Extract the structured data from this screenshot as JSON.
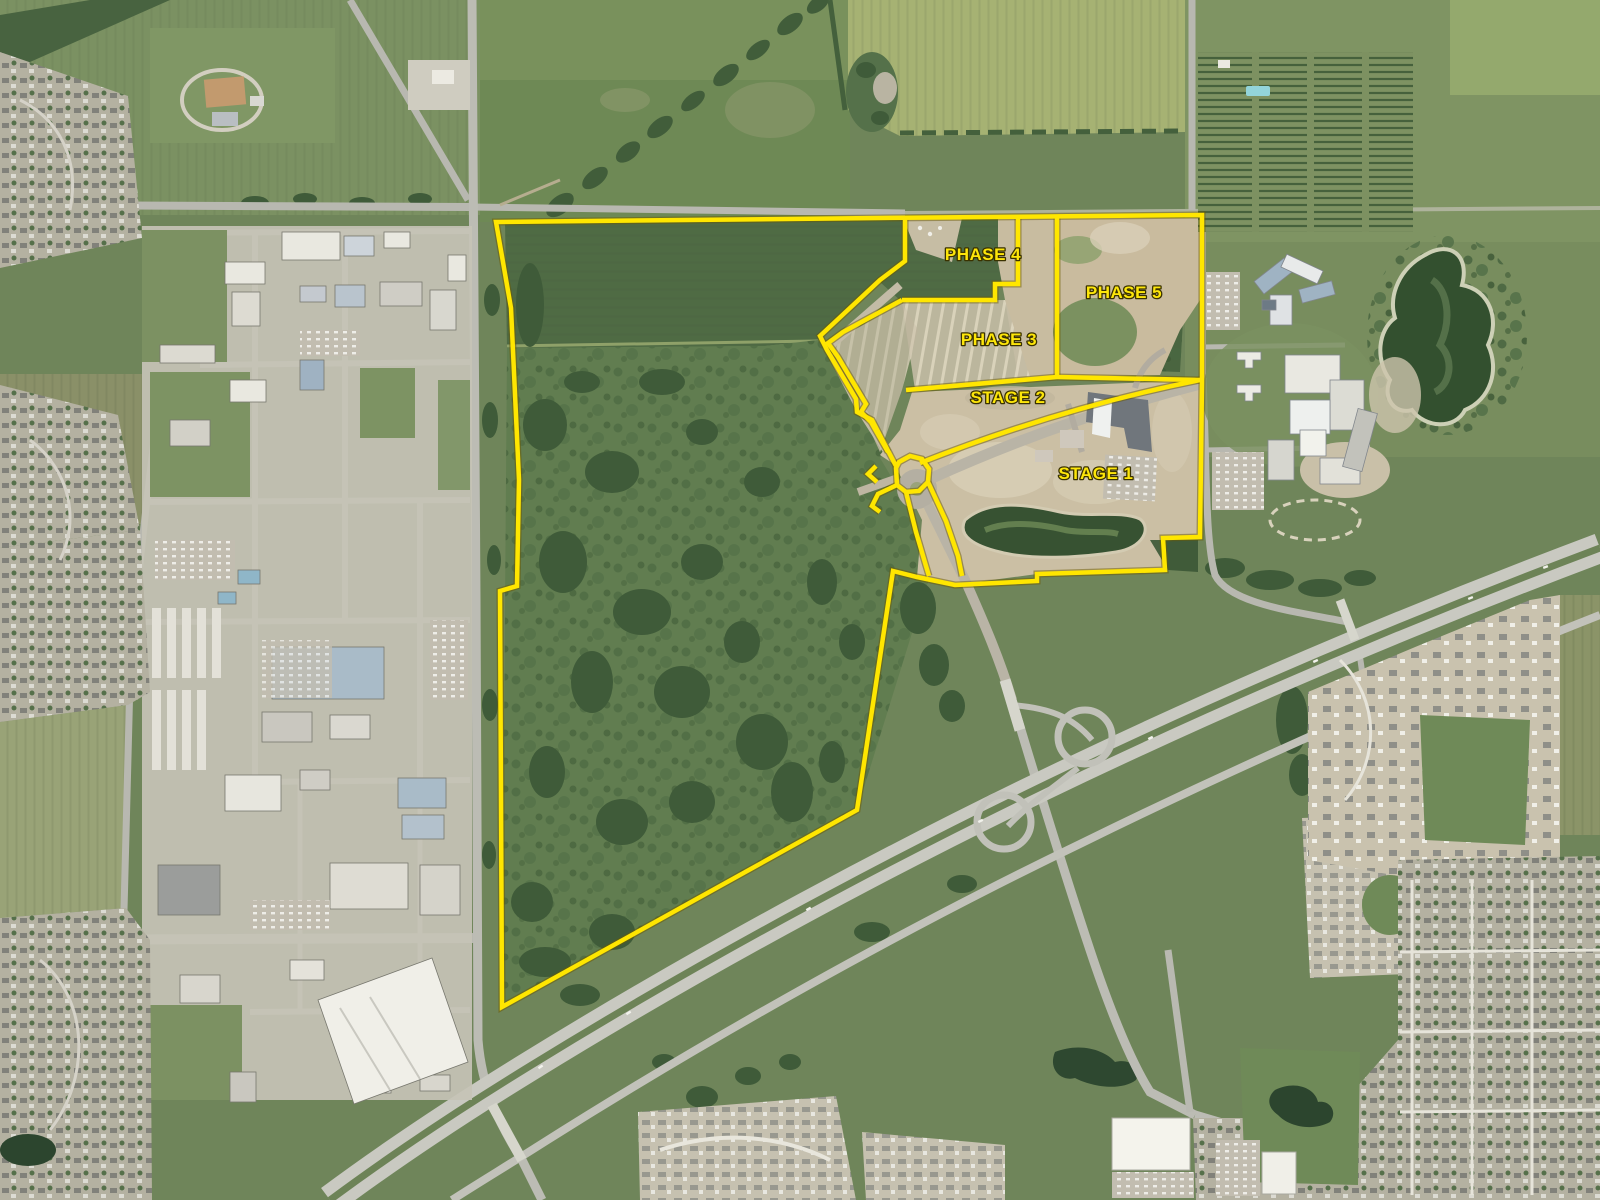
{
  "map": {
    "kind": "aerial-development-phasing-map",
    "overlay": {
      "line_color": "#ffe600",
      "line_outline_color": "#6b5a00",
      "line_width": 4.5,
      "label_color": "#fde60a",
      "label_outline_color": "#3a3200",
      "label_font_size": 17,
      "regions": [
        {
          "id": "phase-4",
          "label": "PHASE 4",
          "label_x": 983,
          "label_y": 260
        },
        {
          "id": "phase-5",
          "label": "PHASE 5",
          "label_x": 1124,
          "label_y": 298
        },
        {
          "id": "phase-3",
          "label": "PHASE 3",
          "label_x": 999,
          "label_y": 345
        },
        {
          "id": "stage-2",
          "label": "STAGE 2",
          "label_x": 1008,
          "label_y": 403
        },
        {
          "id": "stage-1",
          "label": "STAGE 1",
          "label_x": 1096,
          "label_y": 479
        }
      ],
      "boundaries": [
        {
          "id": "outer-parcel-boundary",
          "d": "M496,222 L880,218 L1202,215 L1202,382 L1200,537 L1163,538 L1165,570 L1037,574 L1037,581 L955,585 L917,577 L893,571 L857,810 L502,1007 L500,591 L517,586 L519,480 L511,308 Z"
        },
        {
          "id": "corridor-northwest-edge",
          "d": "M905,218 L905,261 L880,280 L820,336 L827,350 L856,399 L857,412 L872,420 L896,466"
        },
        {
          "id": "corridor-southeast-edge",
          "d": "M902,300 L843,332 L828,343 L838,357 L866,404 L861,412 L871,422 L888,452"
        },
        {
          "id": "phase-4-east-south-edge",
          "d": "M1018,216 L1018,284 L995,284 L995,300 L902,300"
        },
        {
          "id": "phase-3-east-edge",
          "d": "M1057,216 L1057,377"
        },
        {
          "id": "phase-5-south-edge",
          "d": "M1057,377 L1200,380"
        },
        {
          "id": "phase-3-south-edge",
          "d": "M906,390 L1057,377"
        },
        {
          "id": "stage-1-northwest-curve",
          "d": "M920,463 Q1060,408 1200,380"
        },
        {
          "id": "roundabout-loop",
          "d": "M896,468 L899,462 L910,456 L922,459 L929,469 L928,482 L919,491 L906,492 L897,485 Z"
        },
        {
          "id": "roundabout-southwest-stub",
          "d": "M897,485 L878,494 L872,506 L880,512"
        },
        {
          "id": "roundabout-west-notch",
          "d": "M876,466 L868,474 L877,482"
        },
        {
          "id": "site-road-west-line",
          "d": "M906,492 L916,532 L926,566 L929,576"
        },
        {
          "id": "site-road-east-line",
          "d": "M928,482 L946,521 L958,556 L962,576"
        }
      ]
    }
  }
}
